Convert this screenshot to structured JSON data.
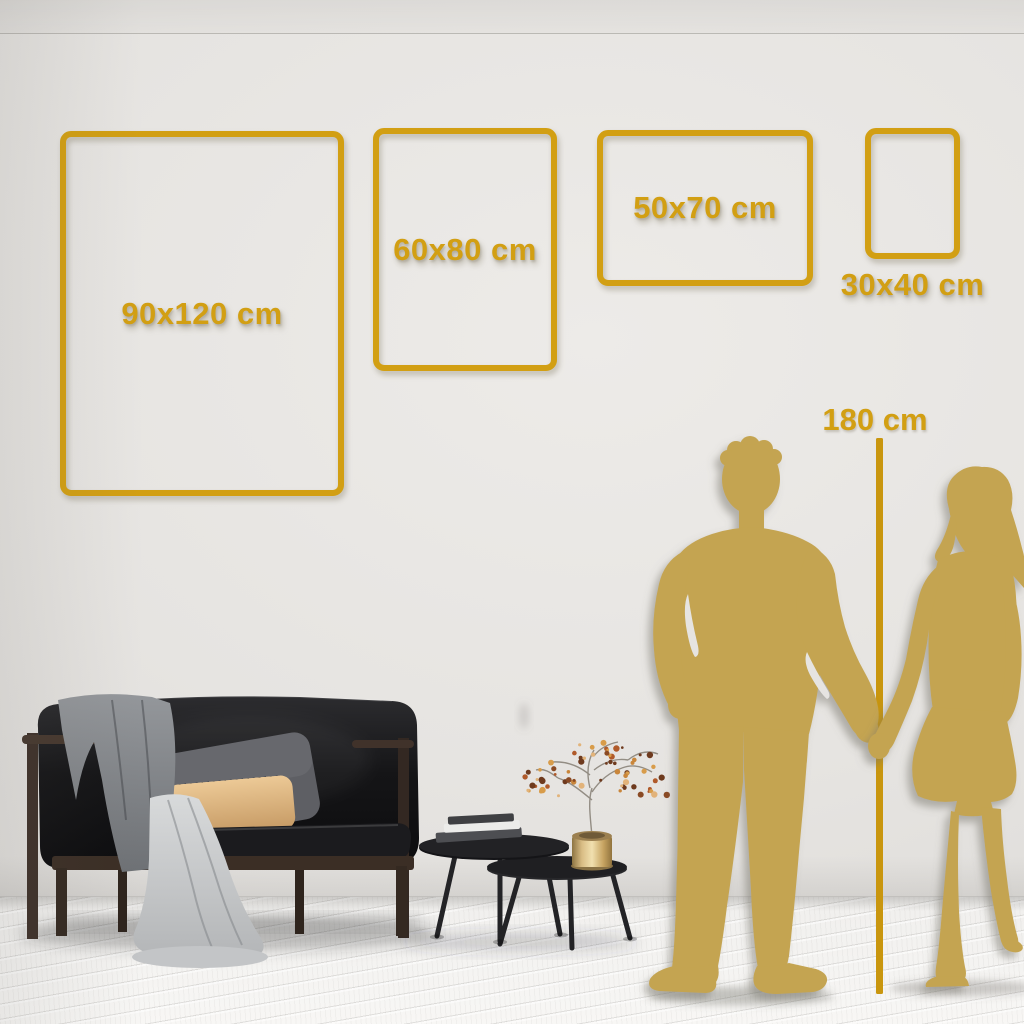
{
  "size_guide": {
    "frames": [
      {
        "id": "90x120",
        "label": "90x120 cm",
        "width_cm": 90,
        "height_cm": 120,
        "orientation": "portrait",
        "label_placement": "inside"
      },
      {
        "id": "60x80",
        "label": "60x80 cm",
        "width_cm": 60,
        "height_cm": 80,
        "orientation": "portrait",
        "label_placement": "inside"
      },
      {
        "id": "50x70",
        "label": "50x70 cm",
        "width_cm": 50,
        "height_cm": 70,
        "orientation": "landscape",
        "label_placement": "inside"
      },
      {
        "id": "30x40",
        "label": "30x40 cm",
        "width_cm": 30,
        "height_cm": 40,
        "orientation": "portrait",
        "label_placement": "below"
      }
    ],
    "height_reference": {
      "label": "180 cm",
      "value_cm": 180
    }
  },
  "colors": {
    "accent_gold": "#d29f13",
    "line_gold": "#c9960e",
    "silhouette_gold": "#c4a451",
    "wall": "#e5e3e0",
    "floor": "#f2f1ef"
  },
  "scene": {
    "objects": [
      "wall",
      "wood-plank-floor",
      "sofa",
      "gray-throw-blanket",
      "draped-blanket",
      "back-pillow",
      "accent-pillow",
      "nesting-coffee-table-large",
      "nesting-coffee-table-small",
      "book-stack",
      "brass-vase",
      "dried-berry-branch",
      "man-silhouette",
      "woman-silhouette",
      "height-reference-line"
    ]
  }
}
